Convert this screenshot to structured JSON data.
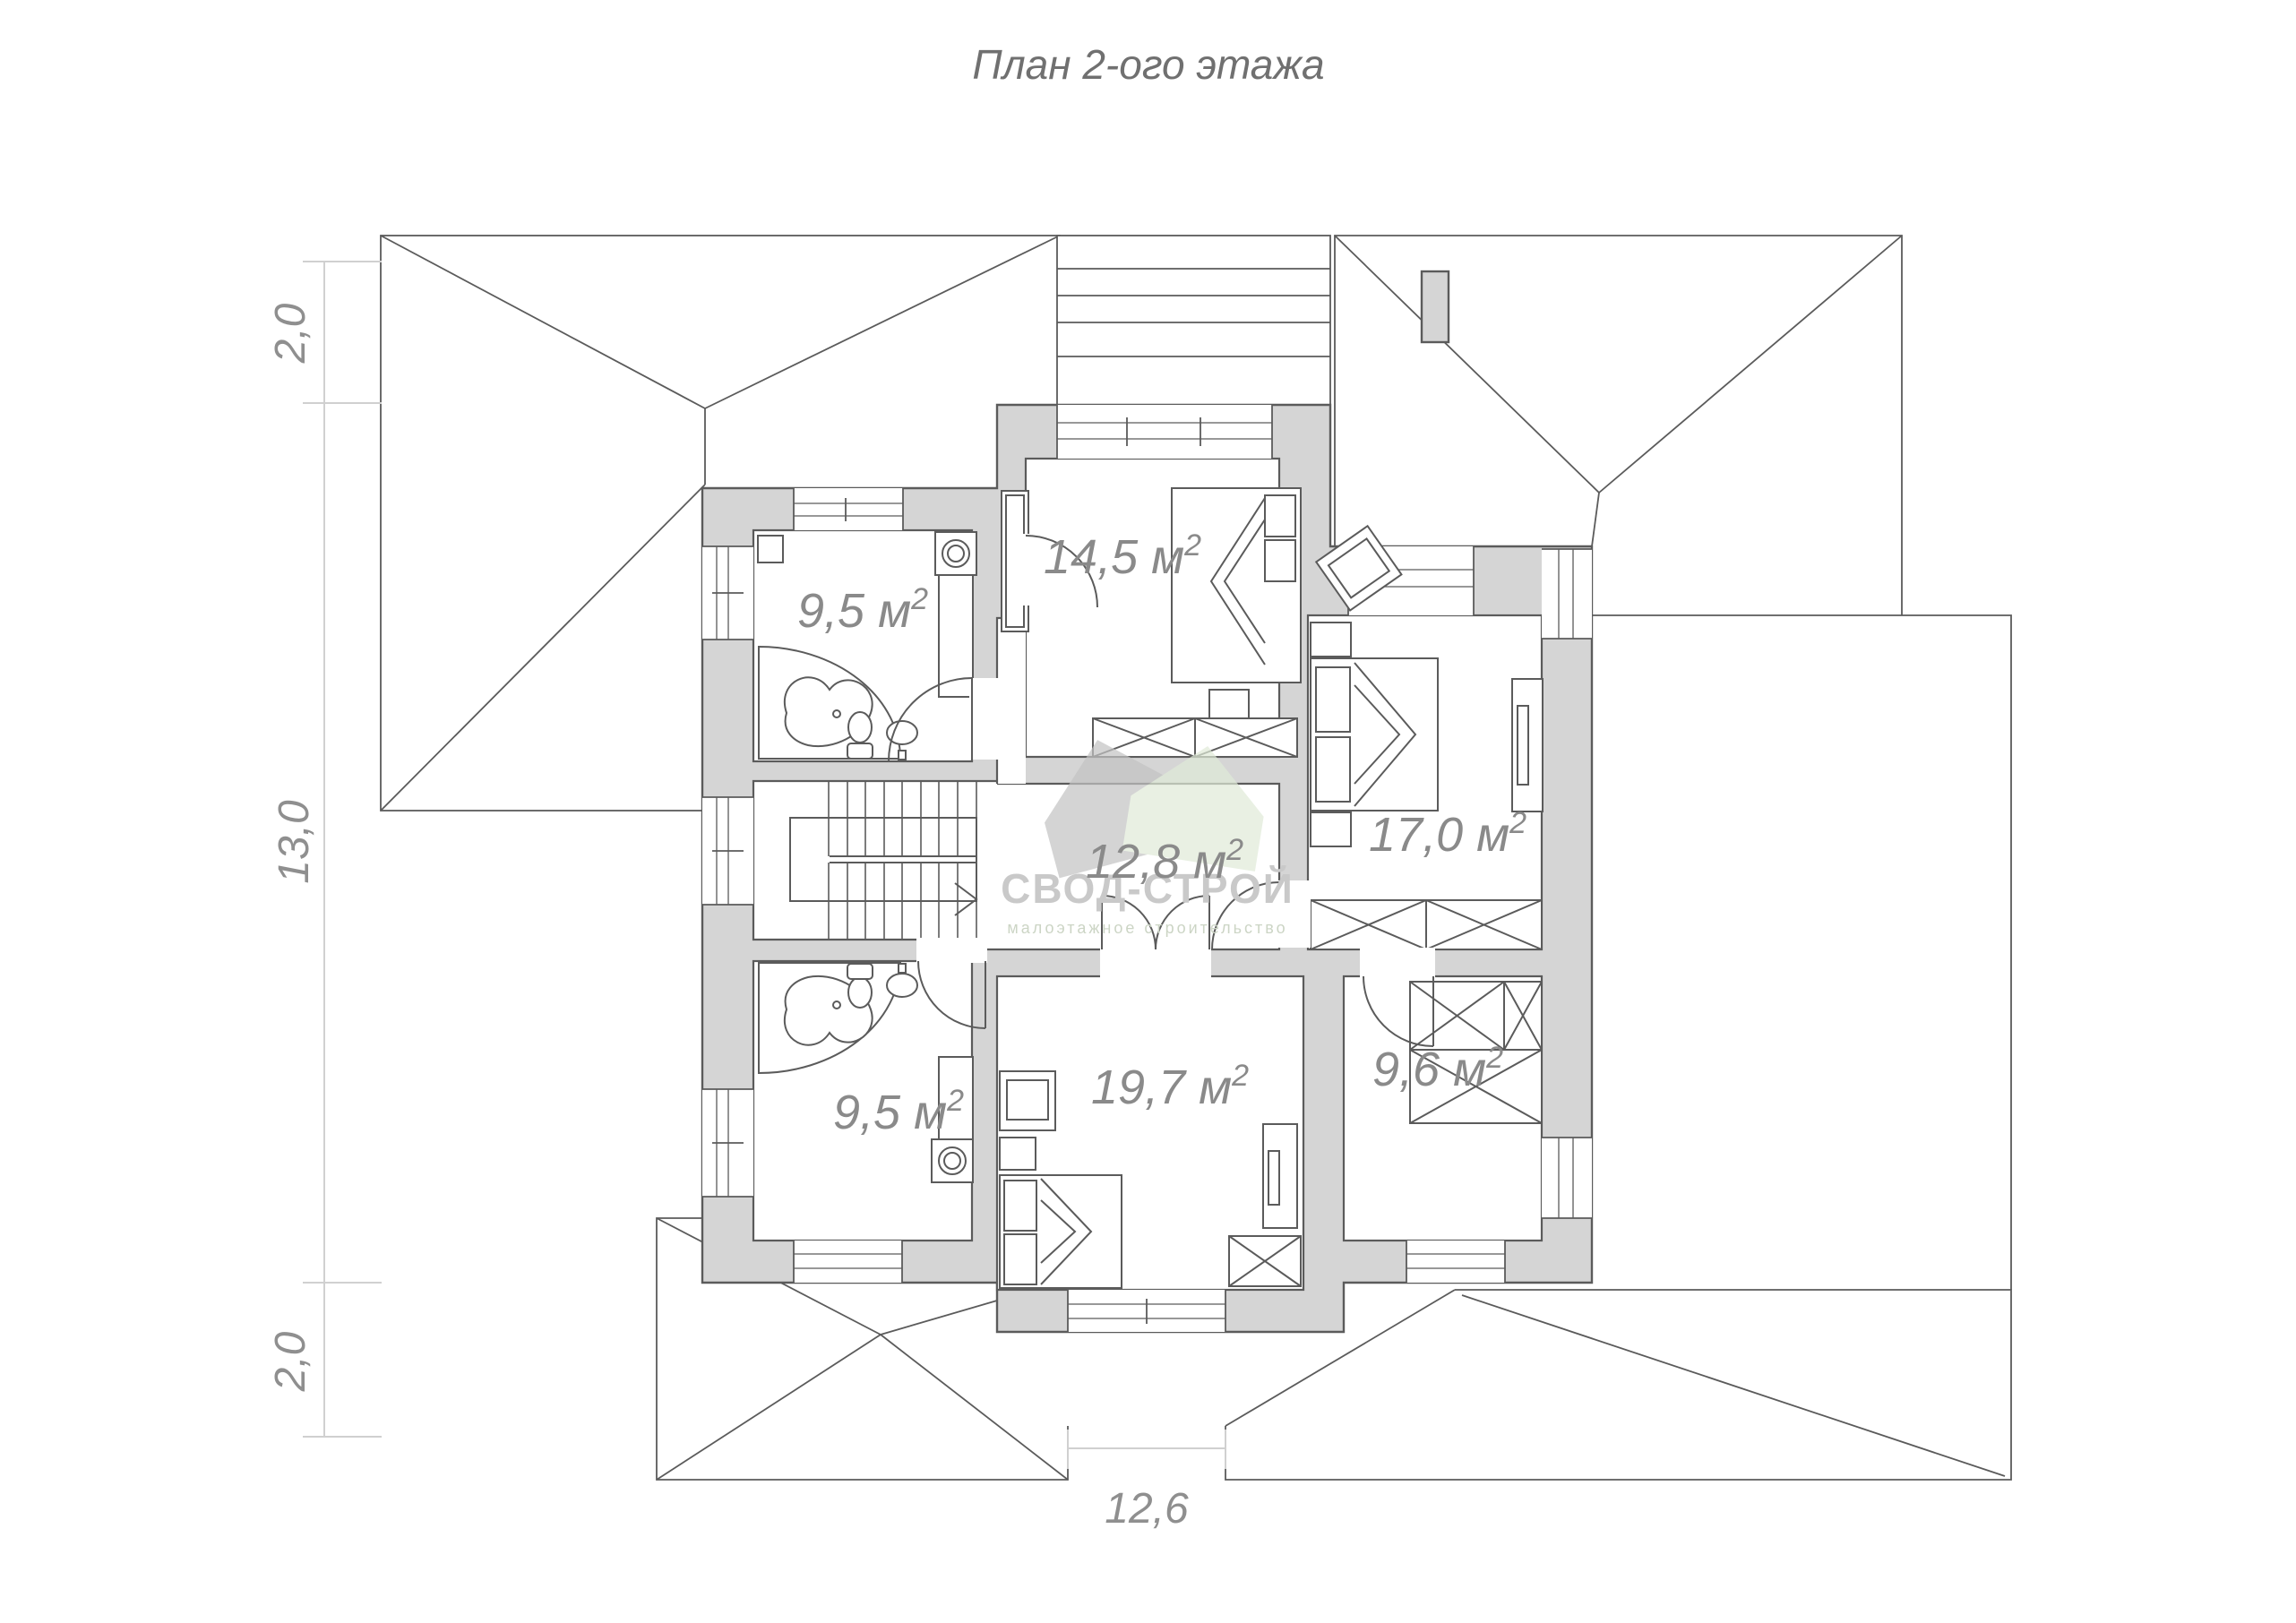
{
  "title": "План 2-ого этажа",
  "watermark": {
    "brand": "СВОД-СТРОЙ",
    "tagline": "малоэтажное строительство"
  },
  "dimensions": {
    "left_top": "2,0",
    "left_middle": "13,0",
    "left_bottom": "2,0",
    "bottom": "12,6"
  },
  "rooms": [
    {
      "id": "bathroom-top",
      "area": "9,5 м",
      "sup": "2"
    },
    {
      "id": "bedroom-top",
      "area": "14,5 м",
      "sup": "2"
    },
    {
      "id": "bedroom-right",
      "area": "17,0 м",
      "sup": "2"
    },
    {
      "id": "hall",
      "area": "12,8 м",
      "sup": "2"
    },
    {
      "id": "bathroom-bottom",
      "area": "9,5 м",
      "sup": "2"
    },
    {
      "id": "bedroom-bottom",
      "area": "19,7 м",
      "sup": "2"
    },
    {
      "id": "wardrobe-room",
      "area": "9,6 м",
      "sup": "2"
    }
  ],
  "colors": {
    "wall_fill": "#d5d5d5",
    "line": "#5b5b5b",
    "dimension_line": "#d0d0d0",
    "label_text": "#8a8a8a",
    "title_text": "#707070",
    "watermark_gray": "#c9c9c9",
    "watermark_green_text": "#ccd5c5",
    "logo_gray": "#c3c3c3",
    "logo_green": "#e0ebd8"
  }
}
